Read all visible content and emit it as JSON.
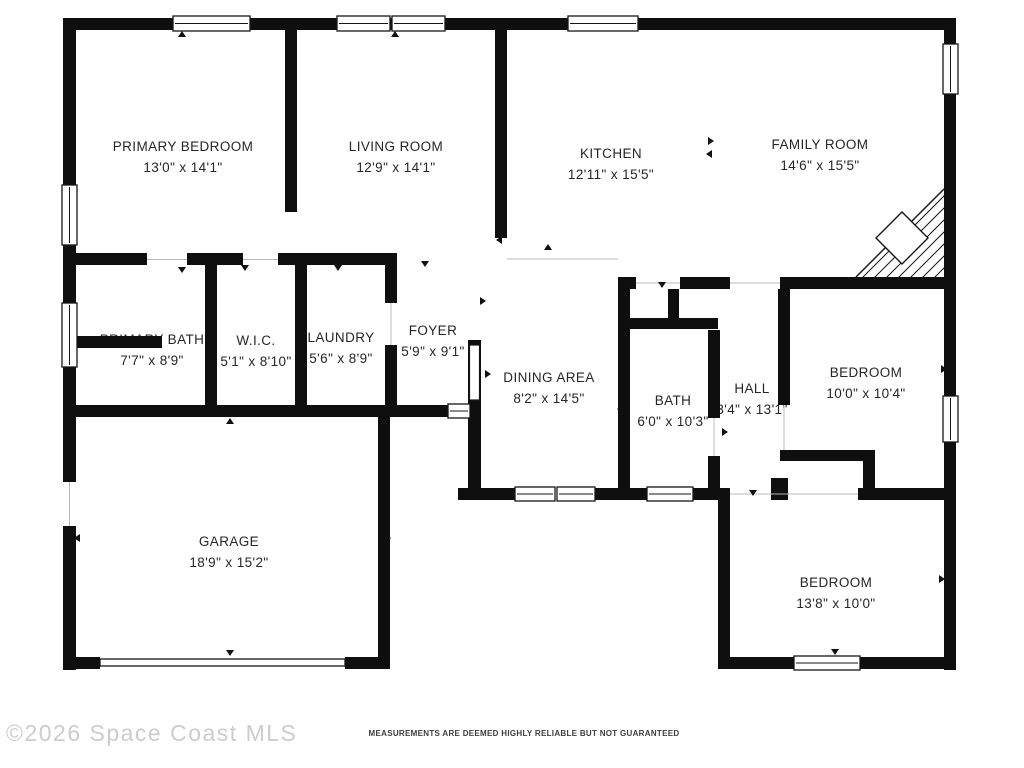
{
  "meta": {
    "watermark": "©2026 Space Coast MLS",
    "disclaimer": "MEASUREMENTS ARE DEEMED HIGHLY RELIABLE BUT NOT GUARANTEED"
  },
  "colors": {
    "background": "#ffffff",
    "wall": "#0f0f0f",
    "room_text": "#262626",
    "watermark_text": "#cccccc",
    "disclaimer_text": "#3d3d3d",
    "opening_line": "#b8b8b8"
  },
  "icons": {
    "window": "double-line white rectangle in wall",
    "door_marker": "small black triangle tick",
    "fireplace": "corner diagonal-hatch triangle with diamond",
    "garage_door": "long thin outlined bar in wall opening",
    "entry_door": "white door leaf rectangle in foyer wall"
  },
  "rooms": [
    {
      "name": "PRIMARY BEDROOM",
      "dims": "13'0\" x 14'1\""
    },
    {
      "name": "LIVING ROOM",
      "dims": "12'9\" x 14'1\""
    },
    {
      "name": "KITCHEN",
      "dims": "12'11\" x 15'5\""
    },
    {
      "name": "FAMILY ROOM",
      "dims": "14'6\" x 15'5\""
    },
    {
      "name": "PRIMARY BATH",
      "dims": "7'7\" x 8'9\""
    },
    {
      "name": "W.I.C.",
      "dims": "5'1\" x 8'10\""
    },
    {
      "name": "LAUNDRY",
      "dims": "5'6\" x 8'9\""
    },
    {
      "name": "FOYER",
      "dims": "5'9\" x 9'1\""
    },
    {
      "name": "DINING AREA",
      "dims": "8'2\" x 14'5\""
    },
    {
      "name": "BATH",
      "dims": "6'0\" x 10'3\""
    },
    {
      "name": "HALL",
      "dims": "3'4\" x 13'1\""
    },
    {
      "name": "BEDROOM",
      "dims": "10'0\" x 10'4\""
    },
    {
      "name": "GARAGE",
      "dims": "18'9\" x 15'2\""
    },
    {
      "name": "BEDROOM",
      "dims": "13'8\" x 10'0\""
    }
  ]
}
